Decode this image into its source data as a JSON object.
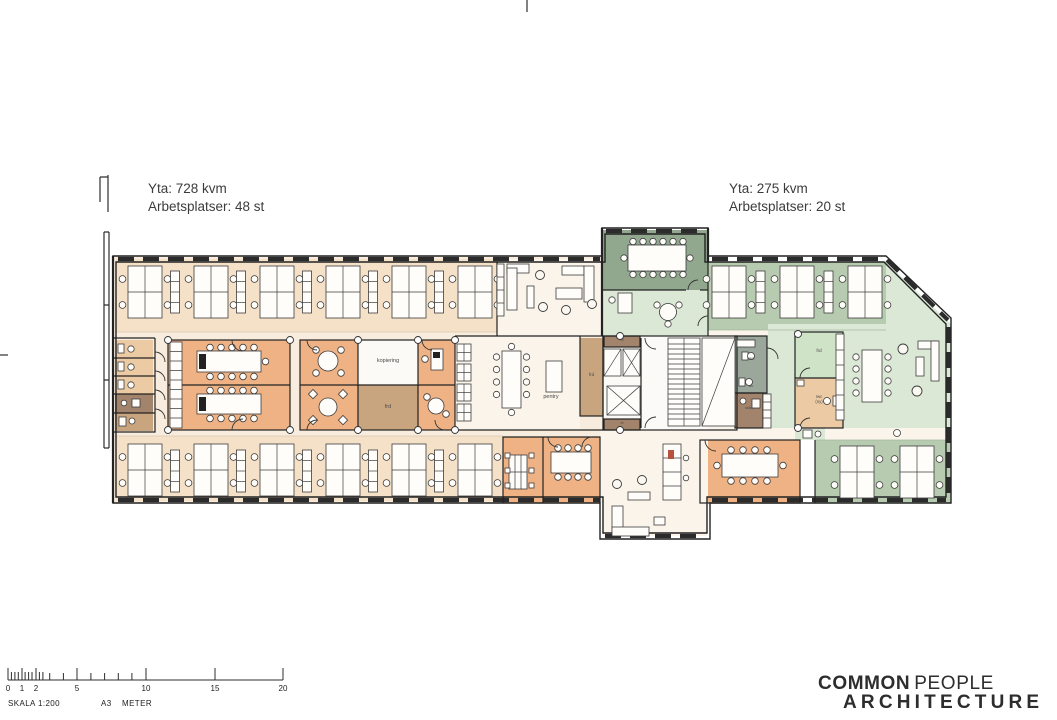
{
  "document": {
    "type": "architectural floor plan"
  },
  "annotations": {
    "left": {
      "area": "Yta: 728 kvm",
      "workplaces": "Arbetsplatser: 48 st"
    },
    "right": {
      "area": "Yta: 275 kvm",
      "workplaces": "Arbetsplatser: 20 st"
    }
  },
  "plan": {
    "labels": {
      "kopiering": "kopiering",
      "frd_block": "frd",
      "frd_core": "frd",
      "frd_right": "frd",
      "pentry": "pentry",
      "rwc": "rwc",
      "wc": "wc",
      "stad": "städ",
      "rwc_ny_1": "rwc",
      "rwc_ny_2": "(ny)",
      "el_top": "el",
      "el_bottom": "el"
    },
    "colors": {
      "wall": "#222222",
      "peach-open": "#f7ecdd",
      "peach-band": "#f5e1c8",
      "orange-room": "#efb285",
      "brown-storage": "#c9a57f",
      "brown-dark": "#a2836b",
      "tan-room": "#eccaa4",
      "white-room": "#fcfaf6",
      "cream": "#faf4ea",
      "sage-dark": "#91a88f",
      "sage-light": "#dbe8d6",
      "sage-mid": "#b7cbb0",
      "green-room": "#cfe3c6",
      "gray-green": "#9ba79b"
    }
  },
  "scale_bar": {
    "ticks": [
      "0",
      "1",
      "2",
      "5",
      "10",
      "15",
      "20"
    ],
    "caption": "SKALA 1:200",
    "sheet": "A3",
    "unit": "METER"
  },
  "logo": {
    "word1": "COMMON",
    "word2": "PEOPLE",
    "word3": "ARCHITECTURE"
  }
}
